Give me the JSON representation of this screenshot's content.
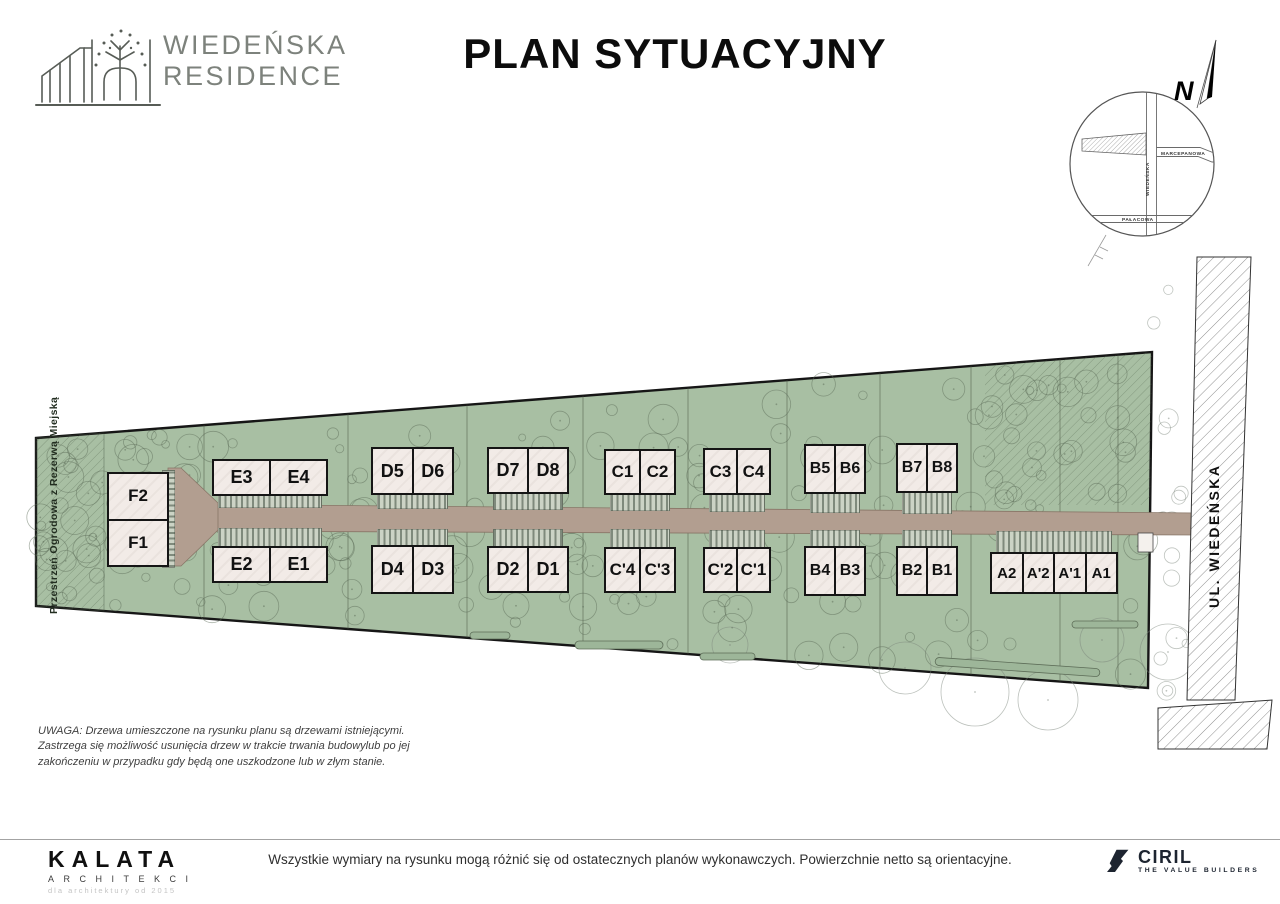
{
  "header": {
    "brand": {
      "line1": "WIEDEŃSKA",
      "line2": "RESIDENCE"
    },
    "title": "PLAN SYTUACYJNY"
  },
  "compass": {
    "north_label": "N",
    "streets": {
      "horizontal_top": "MARCEPANOWA",
      "vertical": "WIEDEŃSKA",
      "horizontal_bottom": "PAŁACOWA"
    }
  },
  "plan": {
    "garden_label": "Przestrzeń Ogrodowa z Rezerwą Miejską",
    "street_label": "UL. WIEDEŃSKA",
    "units": [
      "F2",
      "F1",
      "E3",
      "E4",
      "E2",
      "E1",
      "D5",
      "D6",
      "D4",
      "D3",
      "D7",
      "D8",
      "D2",
      "D1",
      "C1",
      "C2",
      "C'4",
      "C'3",
      "C3",
      "C4",
      "C'2",
      "C'1",
      "B5",
      "B6",
      "B4",
      "B3",
      "B7",
      "B8",
      "B2",
      "B1",
      "A2",
      "A'2",
      "A'1",
      "A1"
    ]
  },
  "note": {
    "text": "UWAGA: Drzewa umieszczone na rysunku planu są drzewami istniejącymi. Zastrzega się możliwość usunięcia drzew w trakcie trwania budowylub po jej zakończeniu w przypadku gdy będą one uszkodzone lub w złym stanie."
  },
  "footer": {
    "disclaimer": "Wszystkie wymiary na rysunku mogą różnić się od ostatecznych planów wykonawczych. Powierzchnie netto są orientacyjne.",
    "kalata": {
      "name": "KALATA",
      "subtitle": "ARCHITEKCI",
      "tagline": "dla architektury od 2015"
    },
    "ciril": {
      "name": "CIRIL",
      "tagline": "THE VALUE BUILDERS"
    }
  },
  "colors": {
    "site_green": "#a8bfa3",
    "road_tan": "#b29e90",
    "building_fill": "#f2ebe7",
    "outline": "#151515"
  }
}
